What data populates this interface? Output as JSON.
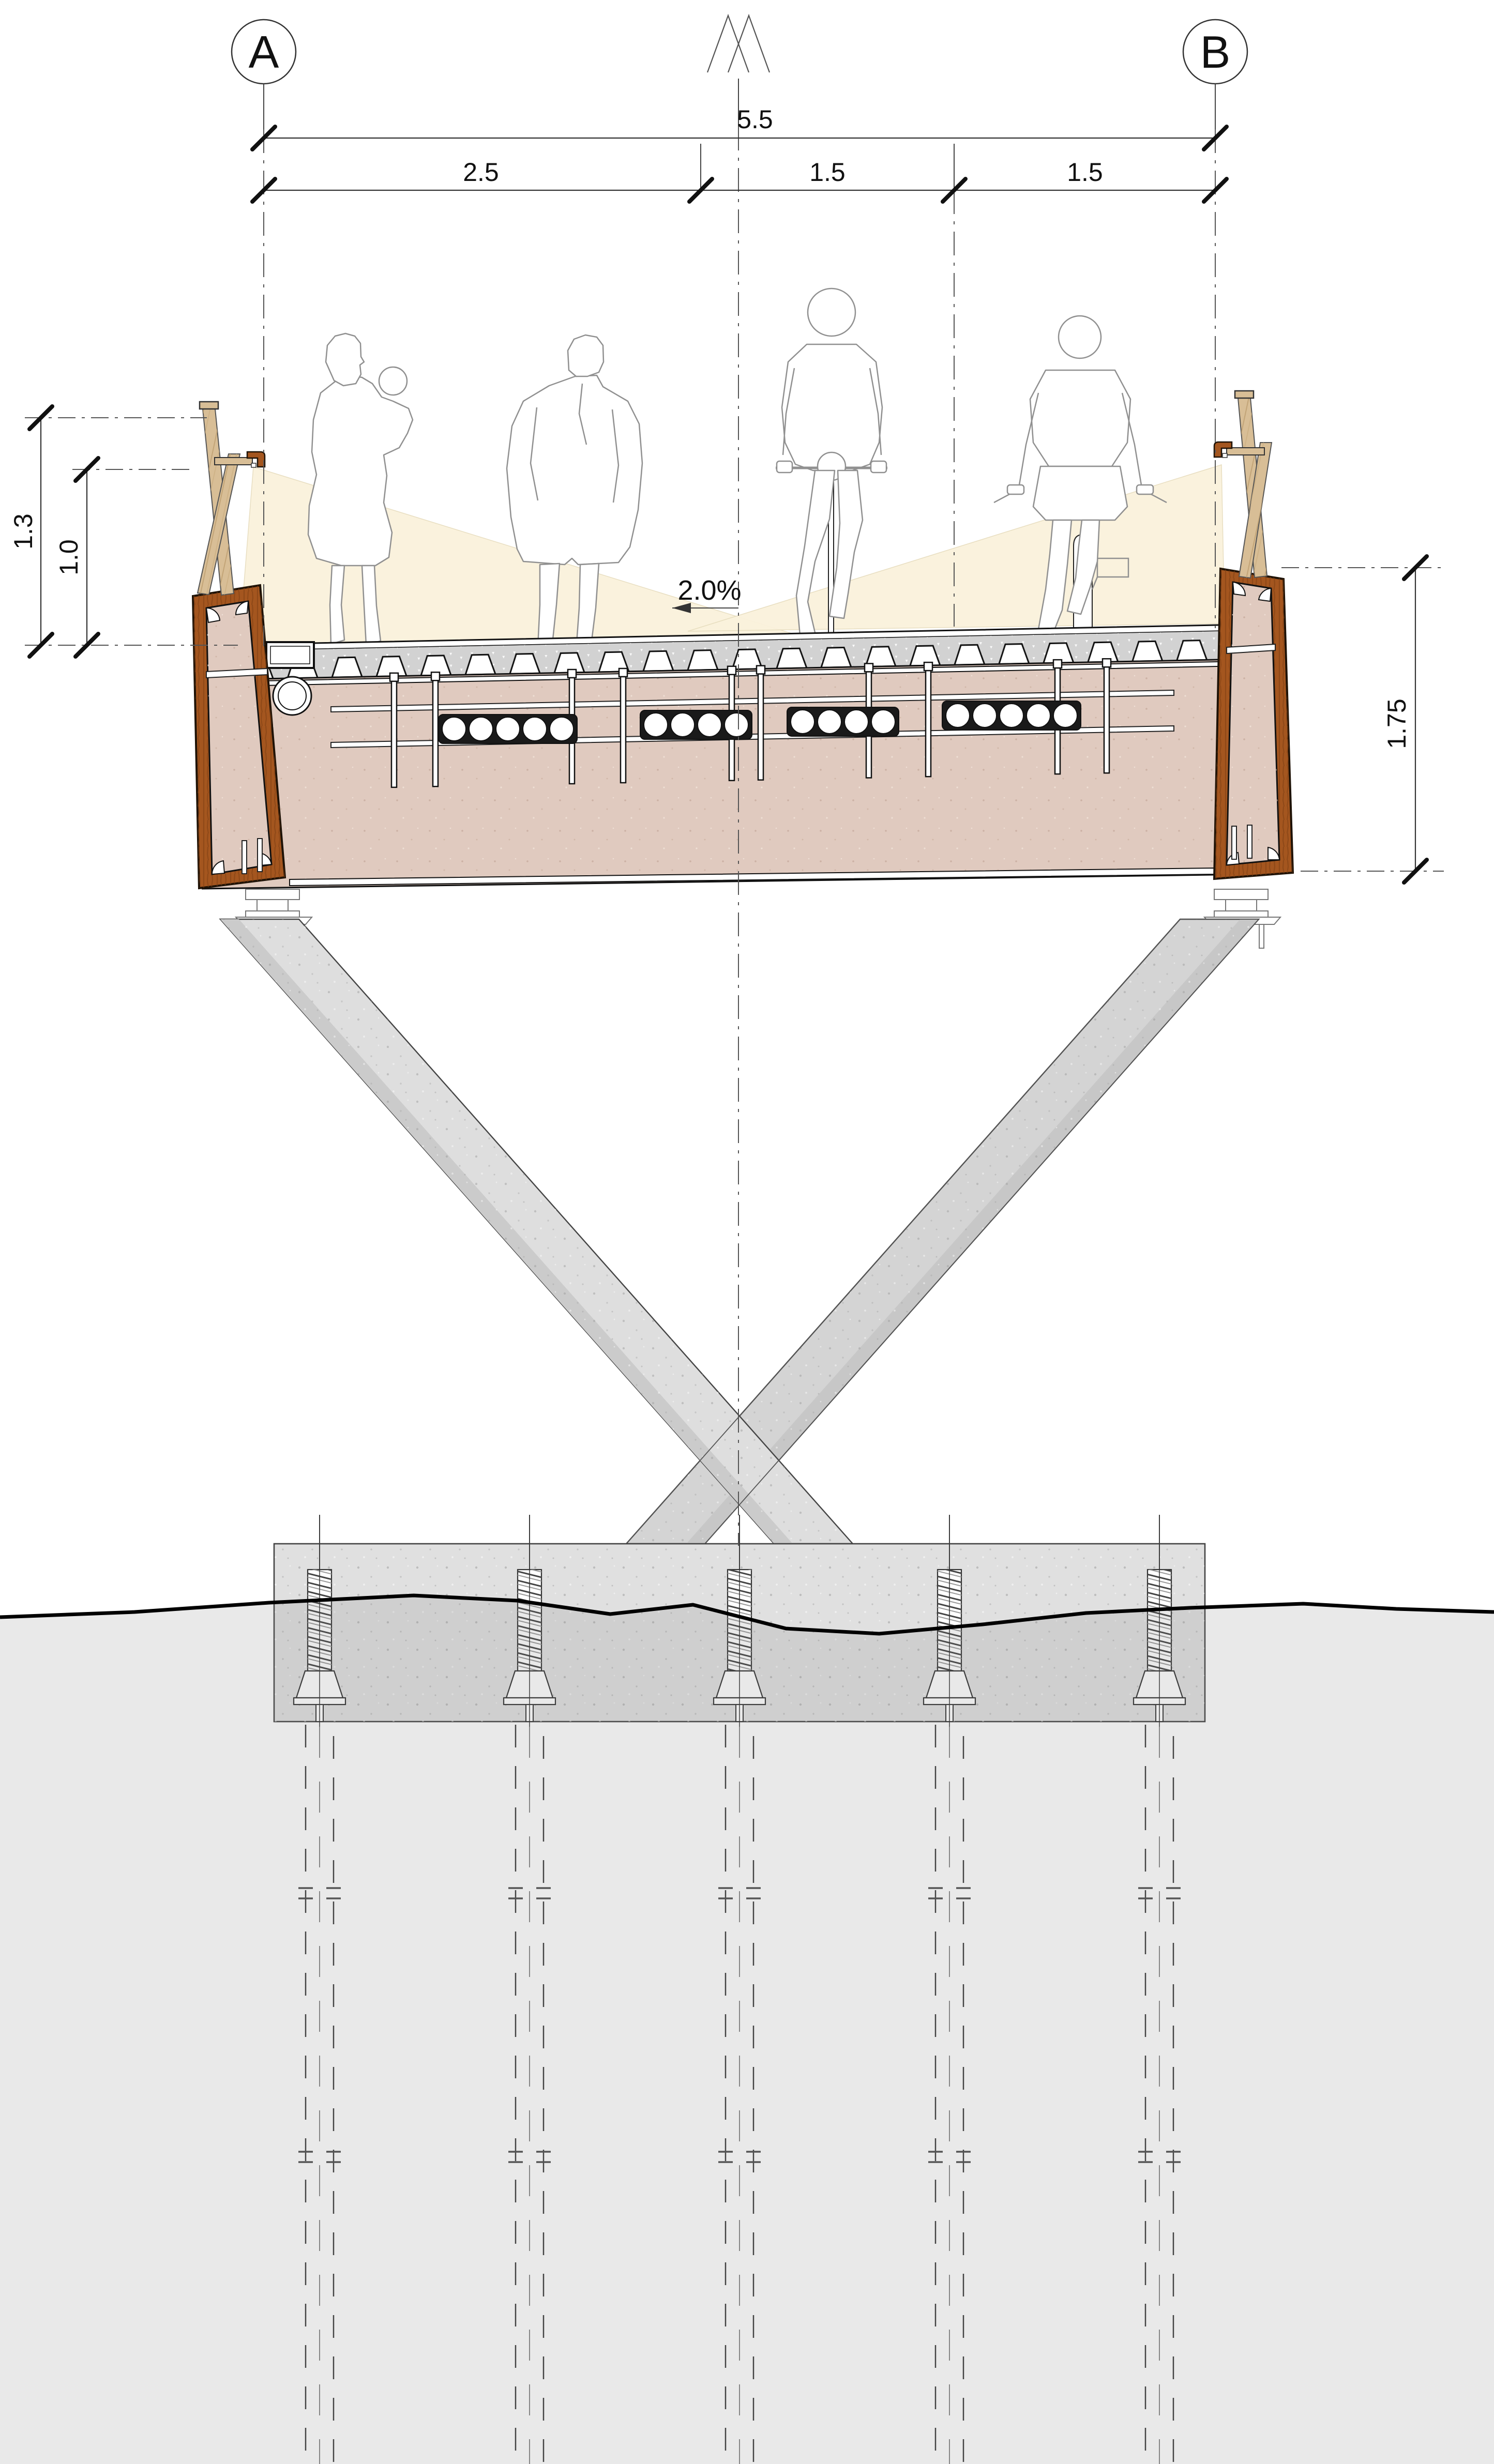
{
  "axes": {
    "left": "A",
    "right": "B"
  },
  "dimensions": {
    "total_width": "5.5",
    "walkway_width": "2.5",
    "lane_left_width": "1.5",
    "lane_right_width": "1.5",
    "parapet_height_upper": "1.3",
    "parapet_height": "1.0",
    "superstructure_depth": "1.75",
    "cross_slope": "2.0%"
  },
  "colors": {
    "girder_brown": "#A4561F",
    "girder_brown_dark": "#7E3D12",
    "deck_fill_pink": "#E0CABF",
    "timber_tan": "#D8BE96",
    "light_beam_cream": "#FAF2DC",
    "concrete_gray": "#E0E0E0",
    "concrete_leg_front": "#DEDEDE",
    "concrete_leg_back": "#D4D4D4",
    "topping_gray": "#D2D2D2",
    "ground_line": "#000000"
  }
}
